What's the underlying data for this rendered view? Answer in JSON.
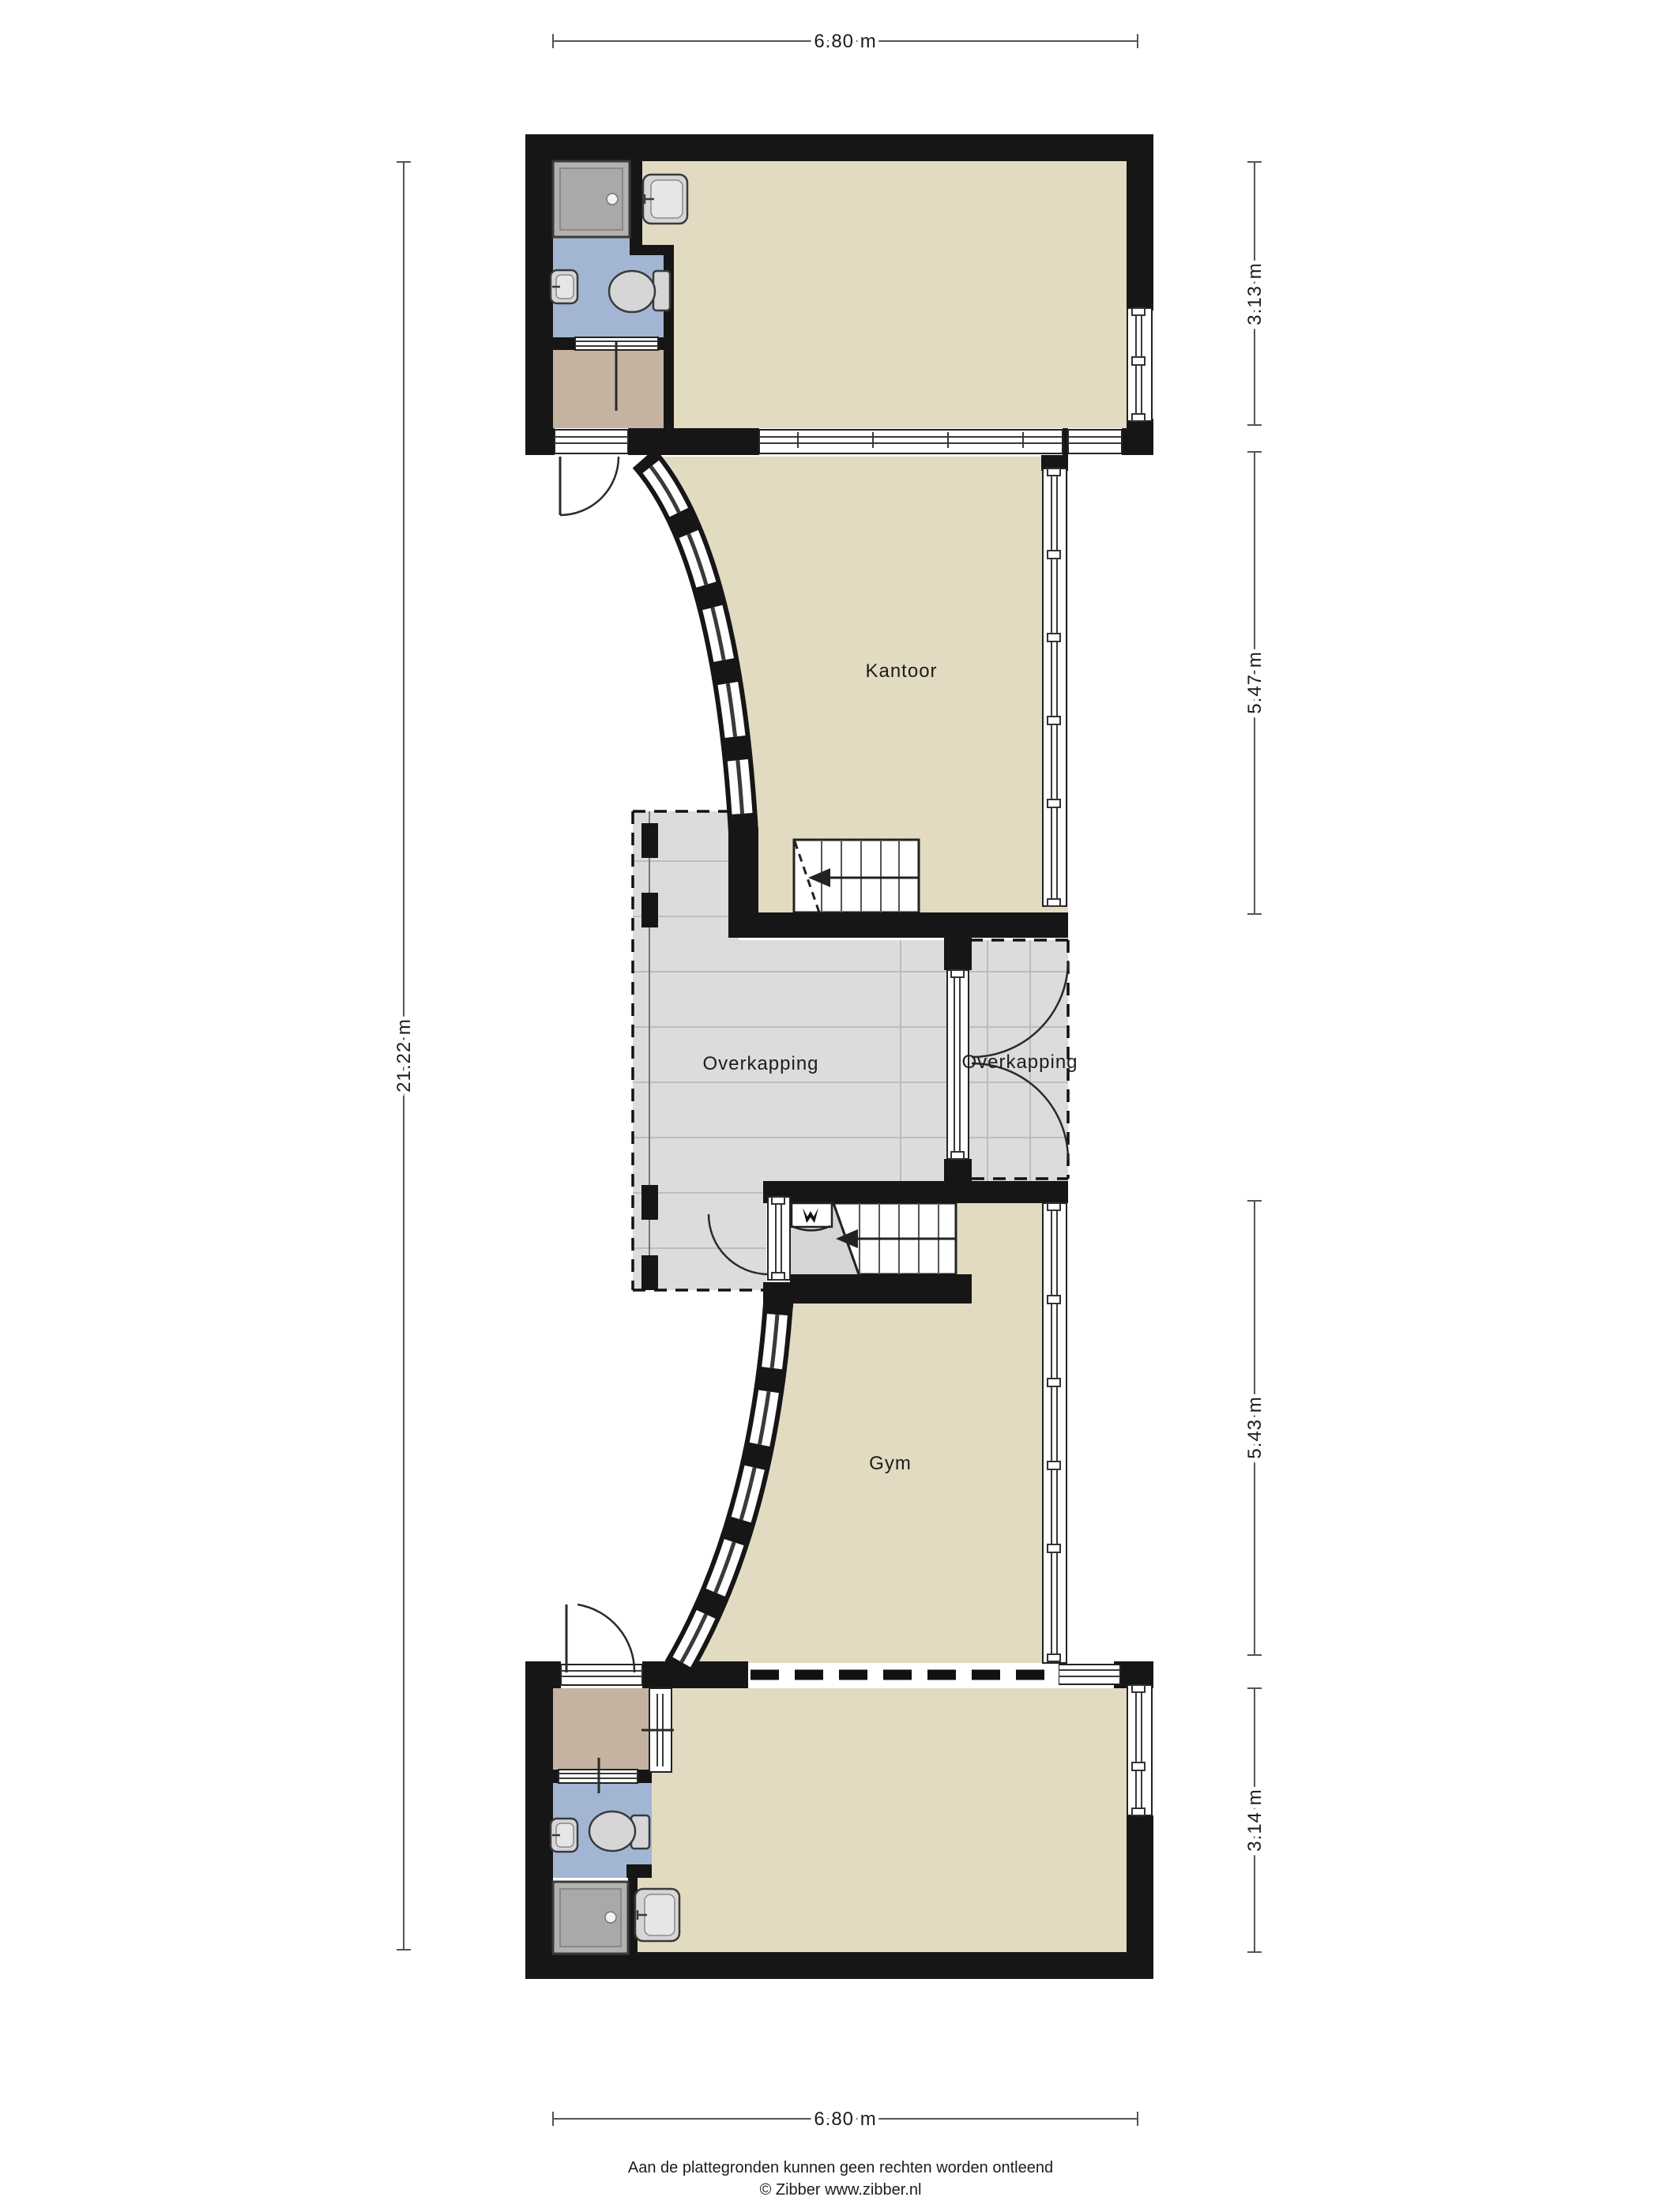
{
  "plan": {
    "title": "floor plan",
    "rooms": {
      "kantoor": "Kantoor",
      "gym": "Gym",
      "overkapping_left": "Overkapping",
      "overkapping_right": "Overkapping"
    },
    "dimensions": {
      "top": "6.80 m",
      "bottom": "6.80 m",
      "left": "21.22 m",
      "right_segments": [
        "3.13 m",
        "5.47 m",
        "5.43 m",
        "3.14 m"
      ]
    },
    "colors": {
      "wall": "#161616",
      "floor_beige": "#e2dbc1",
      "bathroom_blue": "#a2b6d4",
      "hall_brown": "#c4b3a1",
      "canopy_gray": "#dcdcdc",
      "shower_gray": "#b3b0b0"
    },
    "footer": {
      "line1": "Aan de plattegronden kunnen geen rechten worden ontleend",
      "line2": "© Zibber www.zibber.nl"
    }
  }
}
